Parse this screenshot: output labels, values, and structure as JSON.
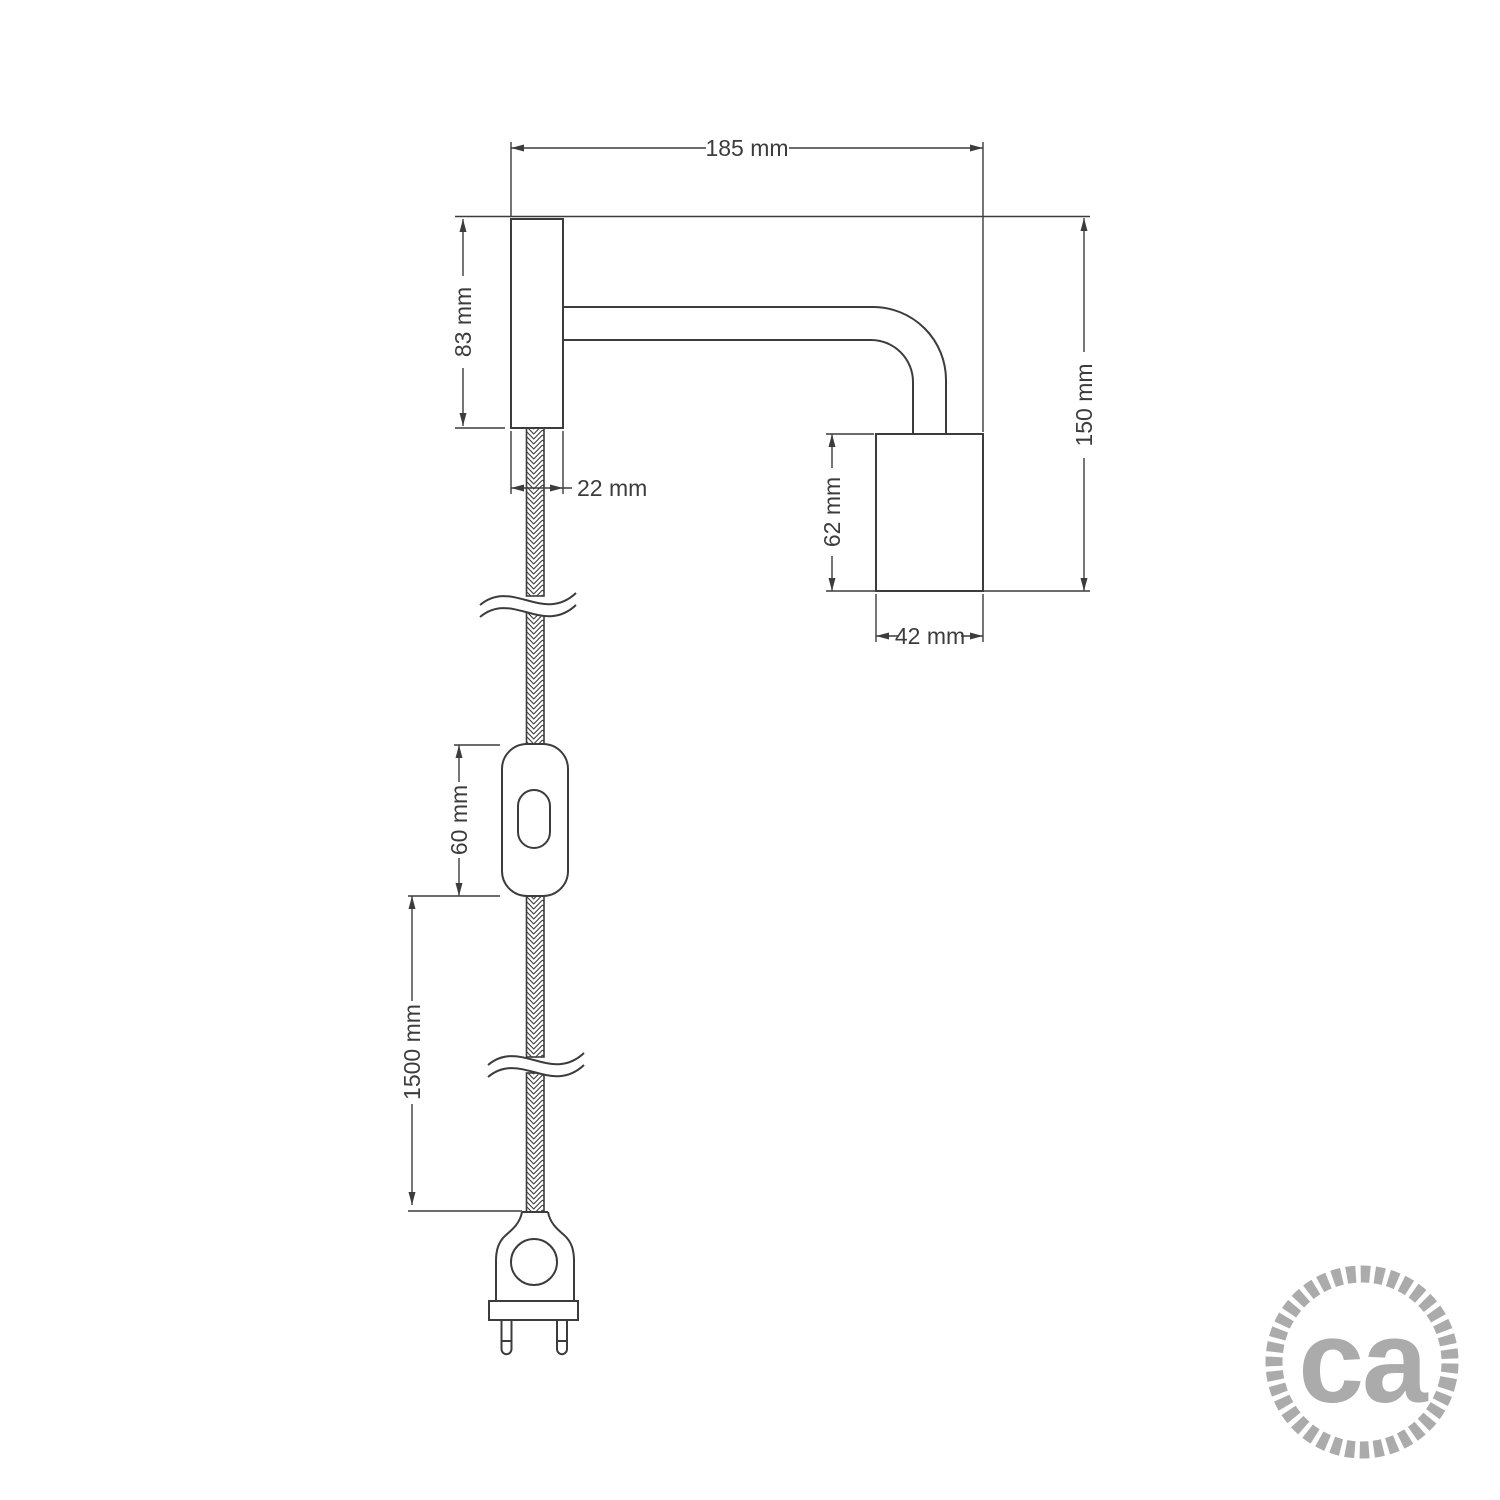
{
  "diagram": {
    "type": "technical-drawing",
    "labels": {
      "total_width": "185 mm",
      "base_height": "83 mm",
      "base_width": "22 mm",
      "total_height": "150 mm",
      "holder_height": "62 mm",
      "holder_width": "42 mm",
      "switch_length": "60 mm",
      "cable_length": "1500 mm"
    },
    "colors": {
      "outline": "#3c3c3c",
      "dimension": "#3c3c3c",
      "logo": "#ababab"
    }
  },
  "logo": {
    "text": "ca"
  }
}
